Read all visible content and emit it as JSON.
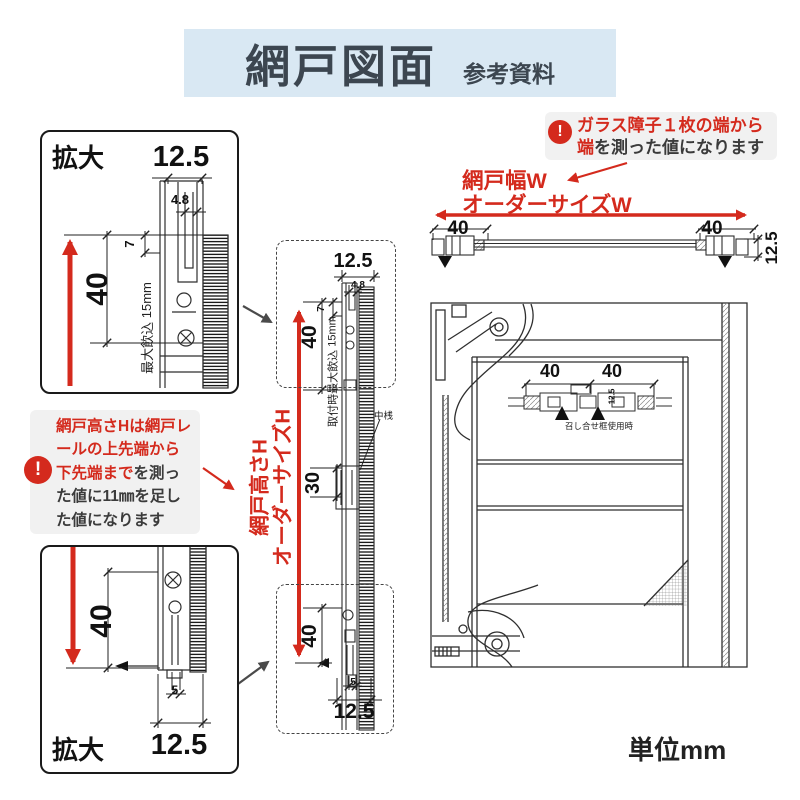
{
  "header": {
    "title": "網戸図面",
    "subtitle": "参考資料"
  },
  "notes": {
    "glass": {
      "line1": "ガラス障子１枚の端から",
      "line2_red": "端",
      "line2_dark": "を測った値になります",
      "icon": "!"
    },
    "height": {
      "line1": "網戸高さHは網戸レ",
      "line2": "ールの上先端から",
      "line3_red": "下先端まで",
      "line3_dark": "を測っ",
      "line4": "た値に11㎜を足し",
      "line5": "た値になります",
      "icon": "!"
    }
  },
  "labels": {
    "enlarge": "拡大",
    "width_line1": "網戸幅W",
    "width_line2": "オーダーサイズW",
    "height_line1": "網戸高さH",
    "height_line2": "オーダーサイズH",
    "swallow_full": "取付時最大飲込",
    "swallow_short": "最大飲込",
    "mid_rail": "中桟",
    "meeting_stile": "召し合せ框使用時",
    "unit": "単位mm"
  },
  "dims": {
    "d125": "12.5",
    "d48": "4.8",
    "d7": "7",
    "d40": "40",
    "d15": "15mm",
    "d30": "30",
    "d5": "5"
  },
  "colors": {
    "accent_red": "#d42a1d",
    "header_bg": "#d9e8f3",
    "header_text": "#3c4650",
    "note_bg": "#f1f1f1",
    "note_dark": "#3b3b3b",
    "line": "#2f2f2f"
  }
}
